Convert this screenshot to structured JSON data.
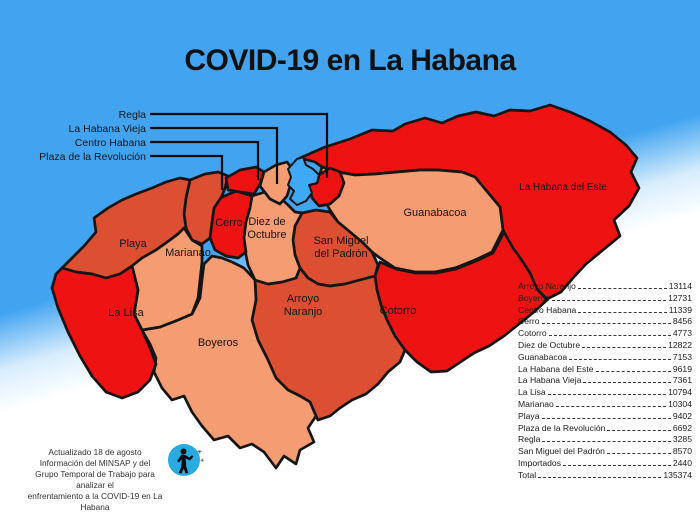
{
  "title": "COVID-19 en La Habana",
  "colors": {
    "sea": "#42a4f0",
    "bay": "#3fa9f5",
    "high": "#ee1212",
    "mid": "#dc4f33",
    "low": "#f59c73",
    "outline": "#151515",
    "icon_blue": "#29abe2"
  },
  "callouts": {
    "regla": "Regla",
    "habana_vieja": "La Habana Vieja",
    "centro_habana": "Centro Habana",
    "plaza": "Plaza de la Revolución"
  },
  "map_labels": {
    "playa": "Playa",
    "marianao": "Marianao",
    "la_lisa": "La Lisa",
    "boyeros": "Boyeros",
    "cerro": "Cerro",
    "diez_1": "Diez de",
    "diez_2": "Octubre",
    "smp_1": "San Miguel",
    "smp_2": "del Padrón",
    "an_1": "Arroyo",
    "an_2": "Naranjo",
    "guanabacoa": "Guanabacoa",
    "cotorro": "Cotorro",
    "hde": "La Habana del Este"
  },
  "table": {
    "rows": [
      {
        "name": "Arroyo Naranjo",
        "value": "13114"
      },
      {
        "name": "Boyeros",
        "value": "12731"
      },
      {
        "name": "Centro Habana",
        "value": "11339"
      },
      {
        "name": "Cerro",
        "value": "8456"
      },
      {
        "name": "Cotorro",
        "value": "4773"
      },
      {
        "name": "Diez de Octubre",
        "value": "12822"
      },
      {
        "name": "Guanabacoa",
        "value": "7153"
      },
      {
        "name": "La Habana del Este",
        "value": "9619"
      },
      {
        "name": "La Habana Vieja",
        "value": "7361"
      },
      {
        "name": "La Lisa",
        "value": "10794"
      },
      {
        "name": "Marianao",
        "value": "10304"
      },
      {
        "name": "Playa",
        "value": "9402"
      },
      {
        "name": "Plaza de la Revolución",
        "value": "6692"
      },
      {
        "name": "Regla",
        "value": "3285"
      },
      {
        "name": "San Miguel del Padrón",
        "value": "8570"
      },
      {
        "name": "Importados",
        "value": "2440"
      },
      {
        "name": "Total",
        "value": "135374"
      }
    ]
  },
  "chart_data": {
    "type": "table",
    "title": "COVID-19 en La Habana",
    "categories": [
      "Arroyo Naranjo",
      "Boyeros",
      "Centro Habana",
      "Cerro",
      "Cotorro",
      "Diez de Octubre",
      "Guanabacoa",
      "La Habana del Este",
      "La Habana Vieja",
      "La Lisa",
      "Marianao",
      "Playa",
      "Plaza de la Revolución",
      "Regla",
      "San Miguel del Padrón",
      "Importados",
      "Total"
    ],
    "values": [
      13114,
      12731,
      11339,
      8456,
      4773,
      12822,
      7153,
      9619,
      7361,
      10794,
      10304,
      9402,
      6692,
      3285,
      8570,
      2440,
      135374
    ]
  },
  "credit": {
    "line1": "Actualizado 18 de agosto",
    "line2": "Información del MINSAP y del",
    "line3": "Grupo Temporal de Trabajo para analizar el",
    "line4": "enfrentamiento a la COVID-19 en La Habana"
  }
}
